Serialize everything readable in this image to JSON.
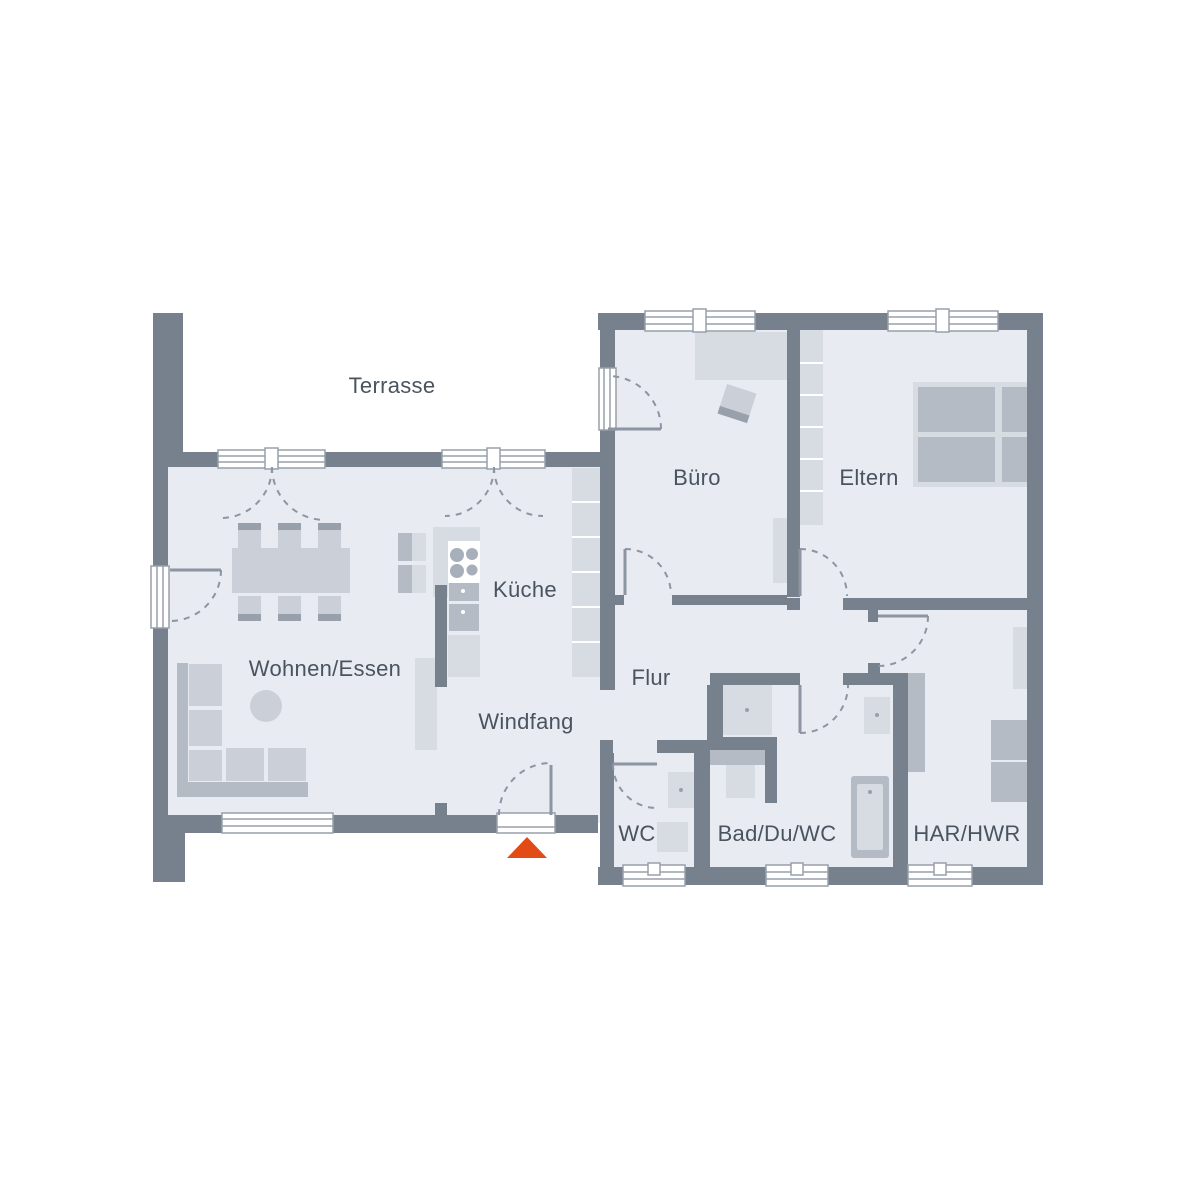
{
  "meta": {
    "type": "floor-plan",
    "style": "architectural top view"
  },
  "palette": {
    "wall": "#77808D",
    "room_fill": "#E8EBF1",
    "terrace_fill": "#FFFFFF",
    "furniture_light": "#D7DBE2",
    "furniture_mid": "#CBD0D8",
    "furniture_dark": "#B5BBC5",
    "accent_band": "#97A0AB",
    "cooktop_ring": "#A7AFBA",
    "window_frame": "#97A0AB",
    "door_arc": "#8C95A1",
    "label": "#4A545F",
    "arrow": "#E24A16",
    "white": "#FFFFFF"
  },
  "rooms": {
    "terrasse": {
      "label": "Terrasse"
    },
    "buero": {
      "label": "Büro"
    },
    "eltern": {
      "label": "Eltern"
    },
    "kueche": {
      "label": "Küche"
    },
    "wohnen_essen": {
      "label": "Wohnen/Essen"
    },
    "flur": {
      "label": "Flur"
    },
    "windfang": {
      "label": "Windfang"
    },
    "wc": {
      "label": "WC"
    },
    "bad": {
      "label": "Bad/Du/WC"
    },
    "har_hwr": {
      "label": "HAR/HWR"
    }
  },
  "entrance": {
    "marker": "triangle-up",
    "meaning": "main entrance"
  }
}
